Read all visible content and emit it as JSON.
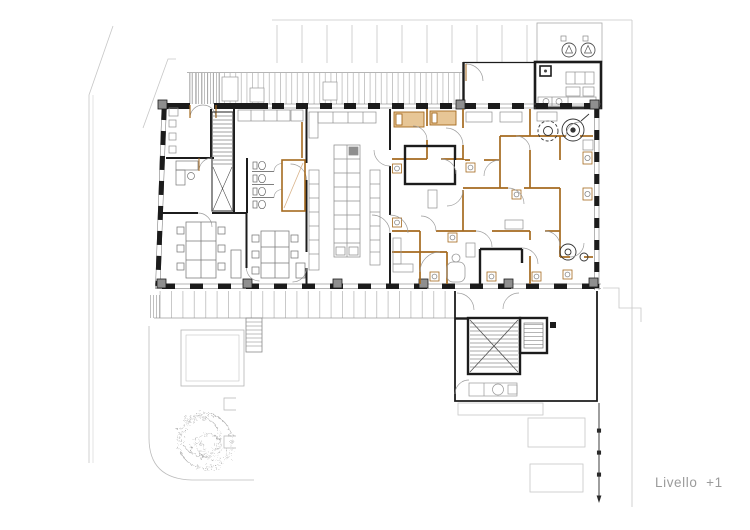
{
  "document": {
    "level_label": "Livello  +1"
  },
  "colors": {
    "paper": "#ffffff",
    "structural_walls": "#1c1c1c",
    "partition_orange": "#a56a1f",
    "partition_fill": "#e7c696",
    "furniture_gray": "#8f8f8f",
    "site_lines": "#c7c7c7",
    "hatch_gray": "#9c9c9c",
    "label_gray": "#9b9b9b"
  },
  "icons": {
    "ventilation_unit": "circle-with-rotor",
    "tree": "sketched-canopy",
    "stair_direction": "x-cross"
  }
}
